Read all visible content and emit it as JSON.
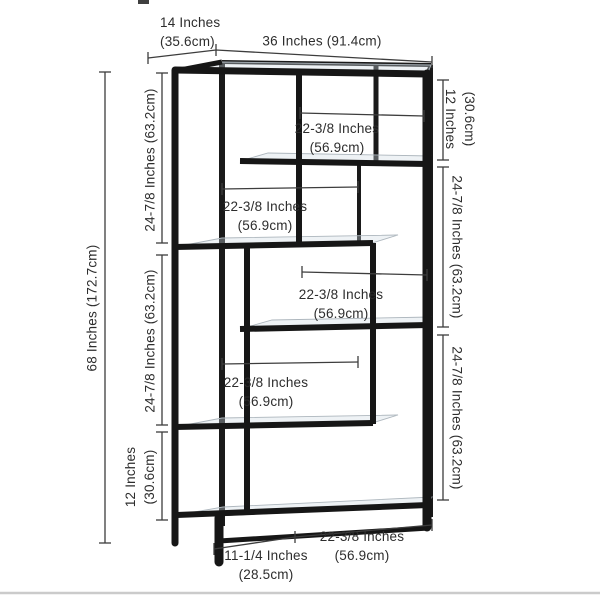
{
  "diagram": {
    "subject": "etagere-bookcase-dimension-diagram",
    "colors": {
      "frame": "#161616",
      "dimension_line": "#3d3d3d",
      "label_text": "#2d2d2d",
      "glass_fill": "#dde6ec",
      "glass_edge": "#adb6bd",
      "floor_line": "#cbcbcb"
    },
    "dims": {
      "depth": {
        "line1": "14 Inches",
        "line2": "(35.6cm)"
      },
      "width": {
        "text": "36 Inches (91.4cm)"
      },
      "height": {
        "text": "68 Inches (172.7cm)"
      },
      "left_upper": {
        "text": "24-7/8 Inches (63.2cm)"
      },
      "left_middle": {
        "text": "24-7/8 Inches (63.2cm)"
      },
      "left_lower": {
        "line1": "12 Inches",
        "line2": "(30.6cm)"
      },
      "right_upper": {
        "line1": "12 Inches",
        "line2": "(30.6cm)"
      },
      "right_middle": {
        "text": "24-7/8 Inches (63.2cm)"
      },
      "right_lower": {
        "text": "24-7/8 Inches (63.2cm)"
      },
      "shelf_1": {
        "line1": "22-3/8 Inches",
        "line2": "(56.9cm)"
      },
      "shelf_2": {
        "line1": "22-3/8 Inches",
        "line2": "(56.9cm)"
      },
      "shelf_3": {
        "line1": "22-3/8 Inches",
        "line2": "(56.9cm)"
      },
      "shelf_4": {
        "line1": "22-3/8 Inches",
        "line2": "(56.9cm)"
      },
      "bottom_shelf": {
        "line1": "22-3/8 Inches",
        "line2": "(56.9cm)"
      },
      "bottom_left": {
        "line1": "11-1/4 Inches",
        "line2": "(28.5cm)"
      }
    }
  }
}
